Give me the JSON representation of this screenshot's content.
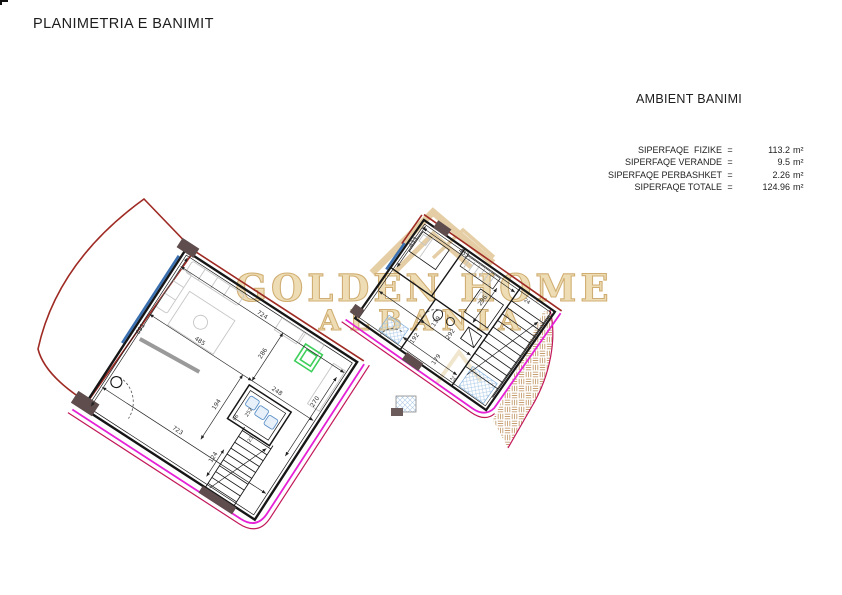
{
  "header": {
    "title": "PLANIMETRIA E BANIMIT"
  },
  "panel": {
    "heading": "AMBIENT BANIMI",
    "rows": [
      {
        "label": "SIPERFAQE  FIZIKE",
        "eq": "=",
        "value": "113.2",
        "unit": "m²"
      },
      {
        "label": "SIPERFAQE VERANDE",
        "eq": "=",
        "value": "9.5",
        "unit": "m²"
      },
      {
        "label": "SIPERFAQE PERBASHKET",
        "eq": "=",
        "value": "2.26",
        "unit": "m²"
      },
      {
        "label": "SIPERFAQE TOTALE",
        "eq": "=",
        "value": "124.96",
        "unit": "m²"
      }
    ]
  },
  "watermark": {
    "line1": "GOLDEN HOME",
    "line2": "ALBANIA"
  },
  "plans": {
    "lower": {
      "dims": [
        "691",
        "724",
        "485",
        "248",
        "286",
        "270",
        "194",
        "723",
        "124",
        "96",
        "252",
        "23"
      ]
    },
    "upper": {
      "dims": [
        "433",
        "453",
        "296",
        "24",
        "119",
        "292",
        "192",
        "179",
        "29"
      ]
    }
  },
  "colors": {
    "wall": "#161616",
    "boundary_red": "#9e2a23",
    "property_magenta": "#e620d6",
    "property_crimson": "#c2185b",
    "railing_blue": "#3a6fb0",
    "shaft_green": "#3ecf5a",
    "watermark_gold": "#dcbe85",
    "hatch_tan": "#c49a6c",
    "fixture_blue": "#5b8fc6"
  }
}
